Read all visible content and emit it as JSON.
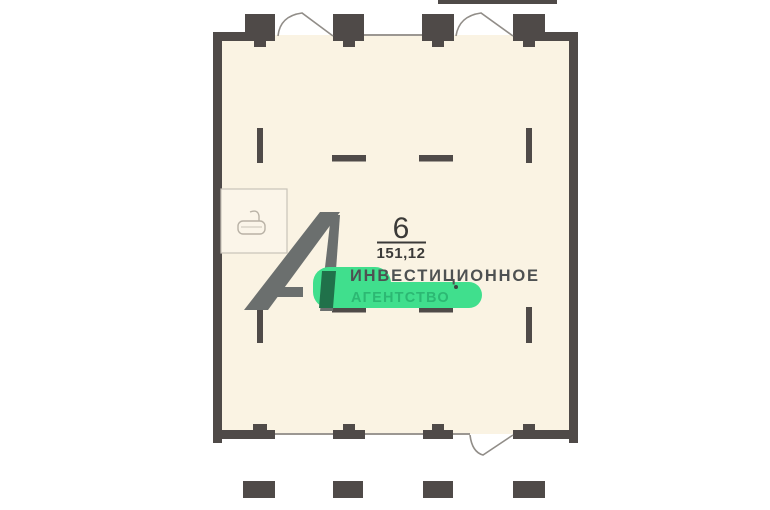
{
  "room_label": {
    "number": "6",
    "area": "151,12"
  },
  "watermark": {
    "logo": "А1",
    "line1": "ИНВЕСТИЦИОННОЕ",
    "line2": "АГЕНТСТВО"
  },
  "icons": {
    "bathtub": "bathtub-icon"
  },
  "colors": {
    "wall": "#4f4a48",
    "floor": "#faf3e3",
    "background": "#ffffff",
    "window_line": "#9b9792",
    "door_arc": "#918d88",
    "bathroom_border": "#c9c3b8",
    "bathtub_stroke": "#b9b2a6",
    "label_text": "#3b3a38",
    "watermark_gray": "#6b6f6e",
    "watermark_text_dark": "#4e5152",
    "highlight_green": "#40df8d",
    "text_green": "#2cb873",
    "dark_green": "#20714a"
  }
}
